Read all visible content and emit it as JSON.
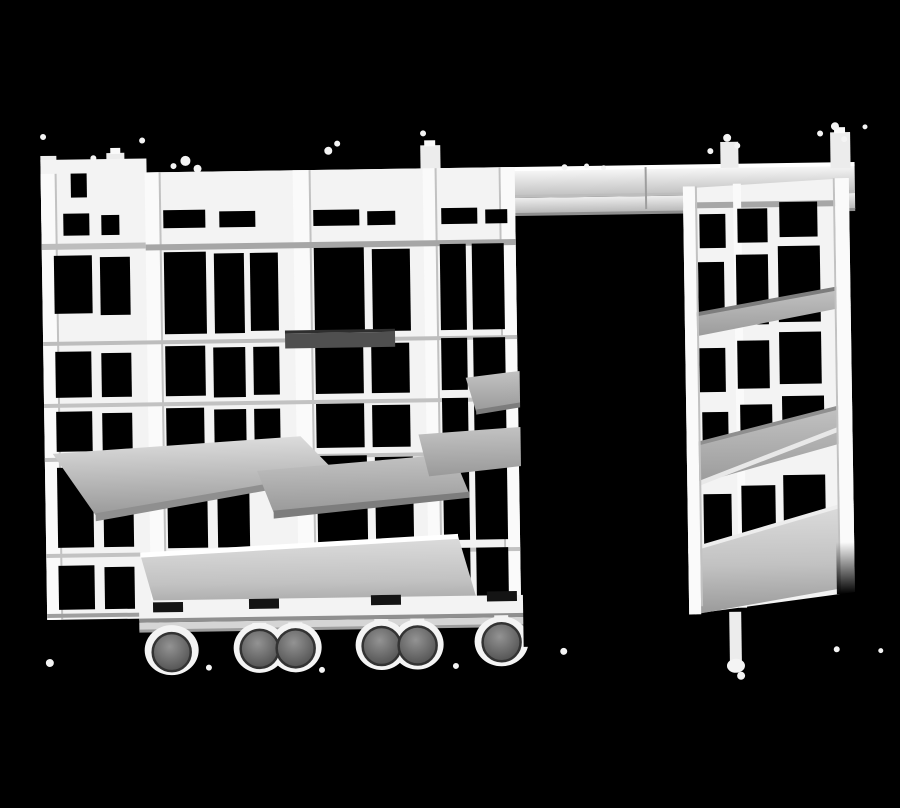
{
  "scene": {
    "label": "Grayscale product photo of a high-density mobile shelving system on an overhead top track, with an open aisle gap and caster wheels, on a black background",
    "parts": {
      "top_track": {
        "name": "top-track",
        "label": "Overhead track beam"
      },
      "left_block": {
        "name": "left-shelving-block",
        "label": "Left group of shelving units"
      },
      "right_unit": {
        "name": "right-shelving-unit",
        "label": "Right shelving unit"
      },
      "aisle_gap": {
        "name": "aisle-gap",
        "label": "Open black aisle gap between units"
      },
      "base": {
        "name": "base-and-casters",
        "label": "Base rail with twin caster wheels"
      },
      "visible_wheel_count": 6,
      "shelf_slab_count": 6
    }
  },
  "colors": {
    "background": "#000000",
    "structure_white": "#f3f3f3",
    "cap_white": "#ececec",
    "post_white": "#fafafa",
    "bright_white": "#ffffff",
    "track_light": "#fafafa",
    "track_dark": "#c0c0c0",
    "rail_light": "#eeeeee",
    "rail_dark": "#b6b6b6",
    "slab_light": "#dcdcdc",
    "slab_mid": "#c2c2c2",
    "slab_dark": "#9a9a9a",
    "dark_shelf_gray": "#4f4f4f",
    "wheel_light": "#939393",
    "wheel_dark": "#454545",
    "wheel_rim": "#333333",
    "clamp_black": "#141414",
    "speckle_white": "#f4f4f4"
  }
}
